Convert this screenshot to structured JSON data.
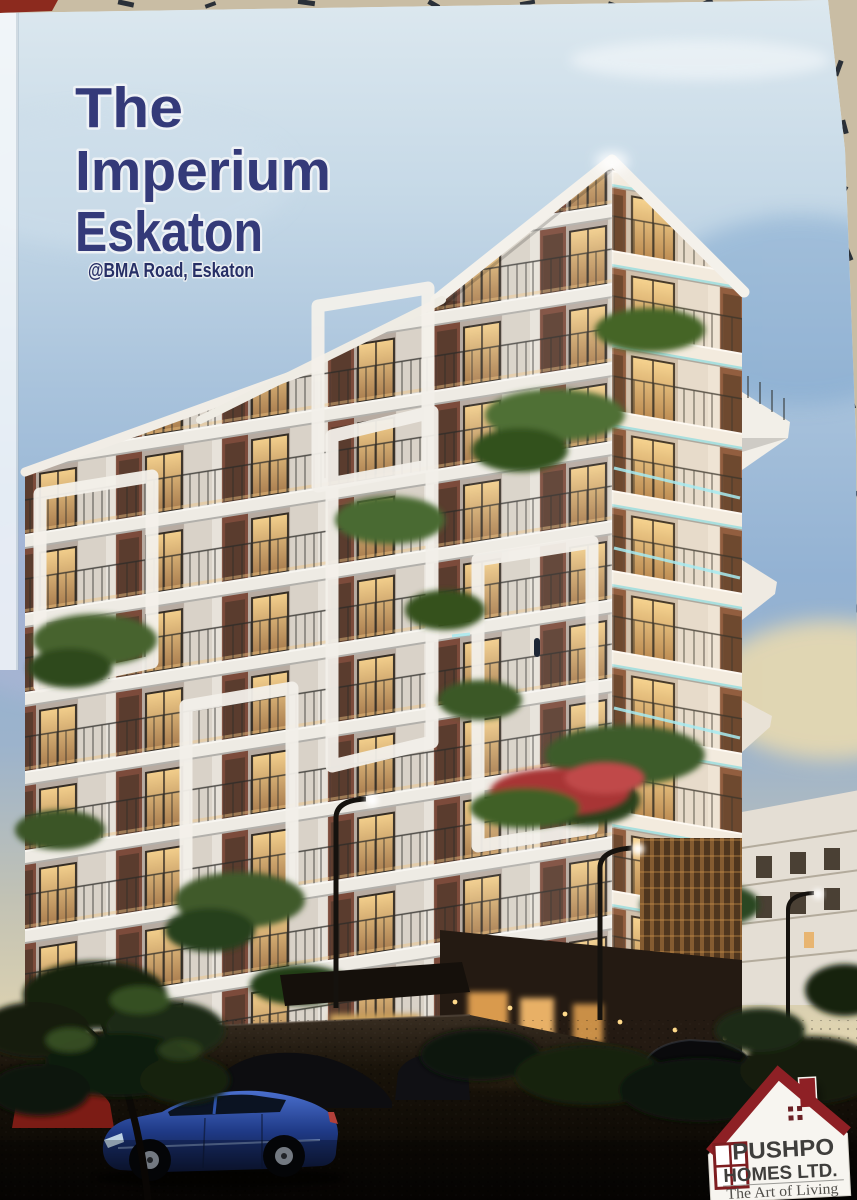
{
  "page": {
    "title_line1": "The",
    "title_line2": "Imperium",
    "title_line3": "Eskaton",
    "subtitle": "@BMA Road, Eskaton"
  },
  "logo": {
    "company_line1": "PUSHPO",
    "company_line2": "HOMES LTD.",
    "tagline": "The Art of Living"
  },
  "colors": {
    "title_navy": "#343a79",
    "subtitle_navy": "#272f66",
    "logo_red": "#8e2025",
    "logo_text_gray": "#3f3e3c",
    "sky_top": "#dce8ef",
    "sky_blue": "#8fadca",
    "sunset_warm": "#e8d8ae",
    "window_glow": "#f3cf8c",
    "led_teal": "#9ae2ea",
    "ground_dark": "#0a0806",
    "hero_car_blue": "#2f54ac"
  }
}
